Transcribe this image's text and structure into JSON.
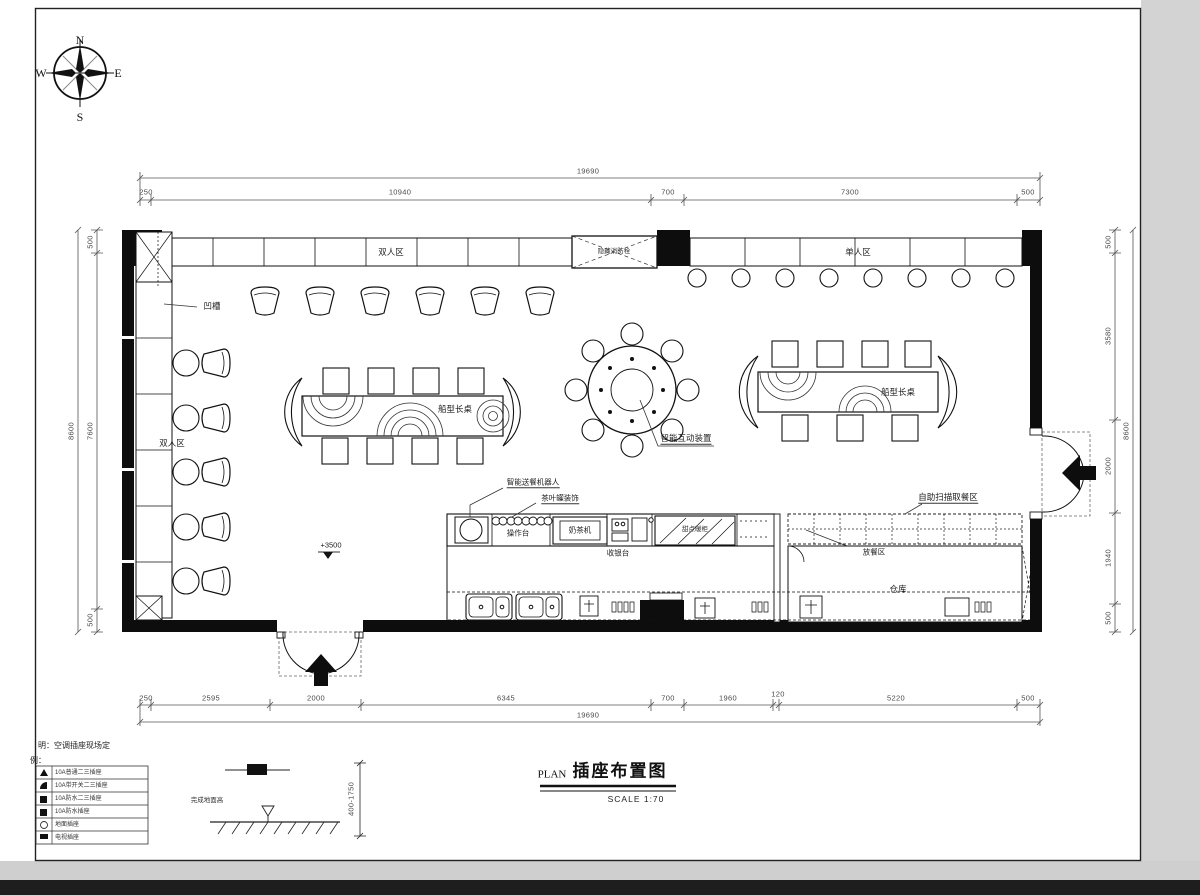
{
  "compass": {
    "n": "N",
    "e": "E",
    "s": "S",
    "w": "W"
  },
  "dimensions": {
    "top": {
      "overall": "19690",
      "segments": [
        "250",
        "10940",
        "700",
        "7300",
        "500"
      ]
    },
    "bottom": {
      "overall": "19690",
      "segments": [
        "250",
        "2595",
        "2000",
        "6345",
        "700",
        "1960",
        "120",
        "5220",
        "500"
      ]
    },
    "left": {
      "overall": "8600",
      "segments": [
        "500",
        "7600",
        "500"
      ]
    },
    "right": {
      "overall": "8600",
      "segments": [
        "500",
        "3580",
        "2000",
        "1940",
        "500"
      ]
    }
  },
  "labels": {
    "double_area_top": "双人区",
    "hidden_fire_hydrant": "隐藏消防栓",
    "single_area": "单人区",
    "groove": "凹槽",
    "double_area_left": "双人区",
    "boat_table_left": "船型长桌",
    "interactive_device": "智能互动装置",
    "boat_table_right": "船型长桌",
    "delivery_robot": "智能送餐机器人",
    "tea_canister_decor": "茶叶罐装饰",
    "work_counter": "操作台",
    "milk_tea_machine": "奶茶机",
    "cashier_counter": "收银台",
    "dessert_cabinet": "甜点暖柜",
    "self_scan_pickup": "自助扫描取餐区",
    "food_serving_area": "放餐区",
    "warehouse": "仓库",
    "ceiling_level": "+3500"
  },
  "title_block": {
    "plan_prefix": "PLAN",
    "title": "插座布置图",
    "scale": "SCALE 1:70"
  },
  "notes": {
    "site_note": "明：空调插座现场定",
    "legend_heading": "例：",
    "floor_finish": "完成地面高",
    "mount_height": "400-1750"
  },
  "legend": {
    "rows": [
      "10A普通二三插座",
      "10A带开关二三插座",
      "10A防水二三插座",
      "10A防水插座",
      "地面插座",
      "电视插座"
    ]
  }
}
